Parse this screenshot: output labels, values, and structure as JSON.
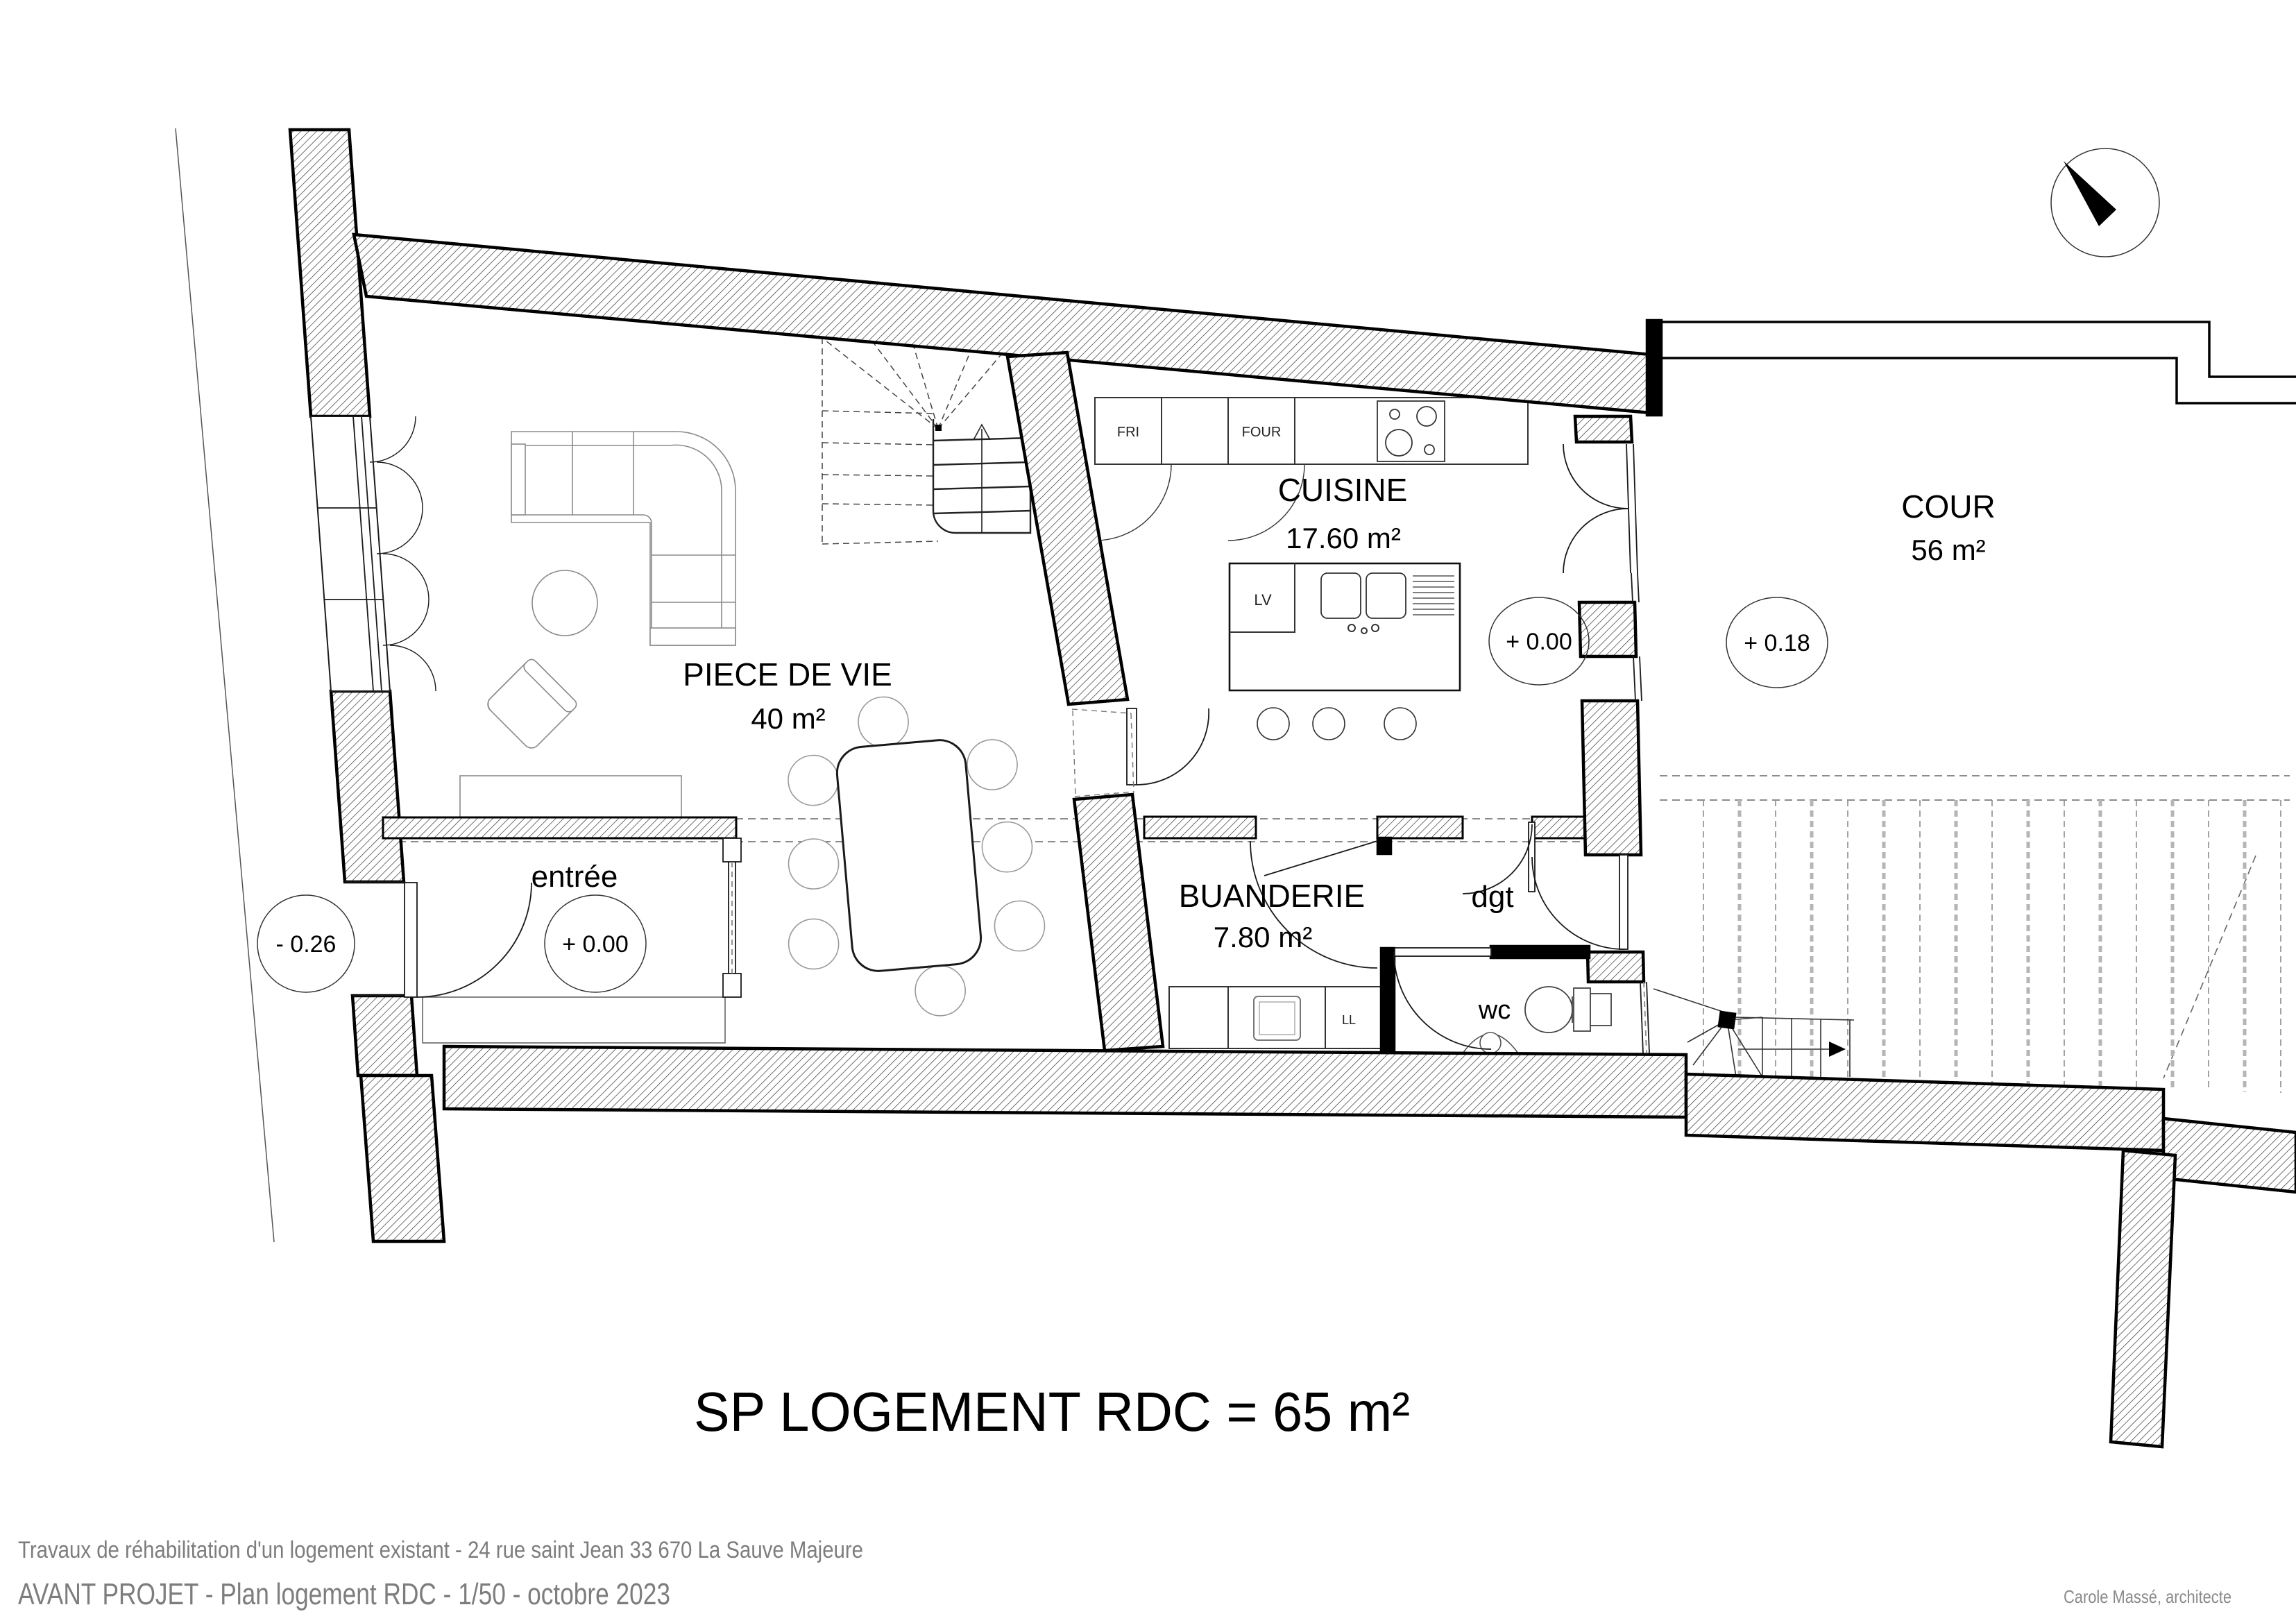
{
  "sheet": {
    "title": "SP LOGEMENT RDC = 65 m²",
    "footer_line1": "Travaux de réhabilitation d'un logement existant - 24 rue saint Jean 33 670 La Sauve Majeure",
    "footer_line2": "AVANT PROJET - Plan logement RDC - 1/50 - octobre 2023",
    "credit": "Carole Massé, architecte"
  },
  "rooms": {
    "living": {
      "name": "PIECE DE VIE",
      "area": "40 m²"
    },
    "kitchen": {
      "name": "CUISINE",
      "area": "17.60 m²"
    },
    "laundry": {
      "name": "BUANDERIE",
      "area": "7.80 m²"
    },
    "court": {
      "name": "COUR",
      "area": "56 m²"
    },
    "entry": {
      "name": "entrée"
    },
    "hall": {
      "name": "dgt"
    },
    "wc": {
      "name": "wc"
    }
  },
  "levels": {
    "street": "- 0.26",
    "entry": "+ 0.00",
    "kitchen": "+ 0.00",
    "court": "+ 0.18"
  },
  "appliances": {
    "fridge": "FRI",
    "oven": "FOUR",
    "dishwasher": "LV",
    "washer": "LL"
  },
  "colors": {
    "wall_hatch_line": "#333333",
    "new_wall": "#000000",
    "furniture": "#8a8a8a",
    "footer_text": "#7d7d7d"
  }
}
